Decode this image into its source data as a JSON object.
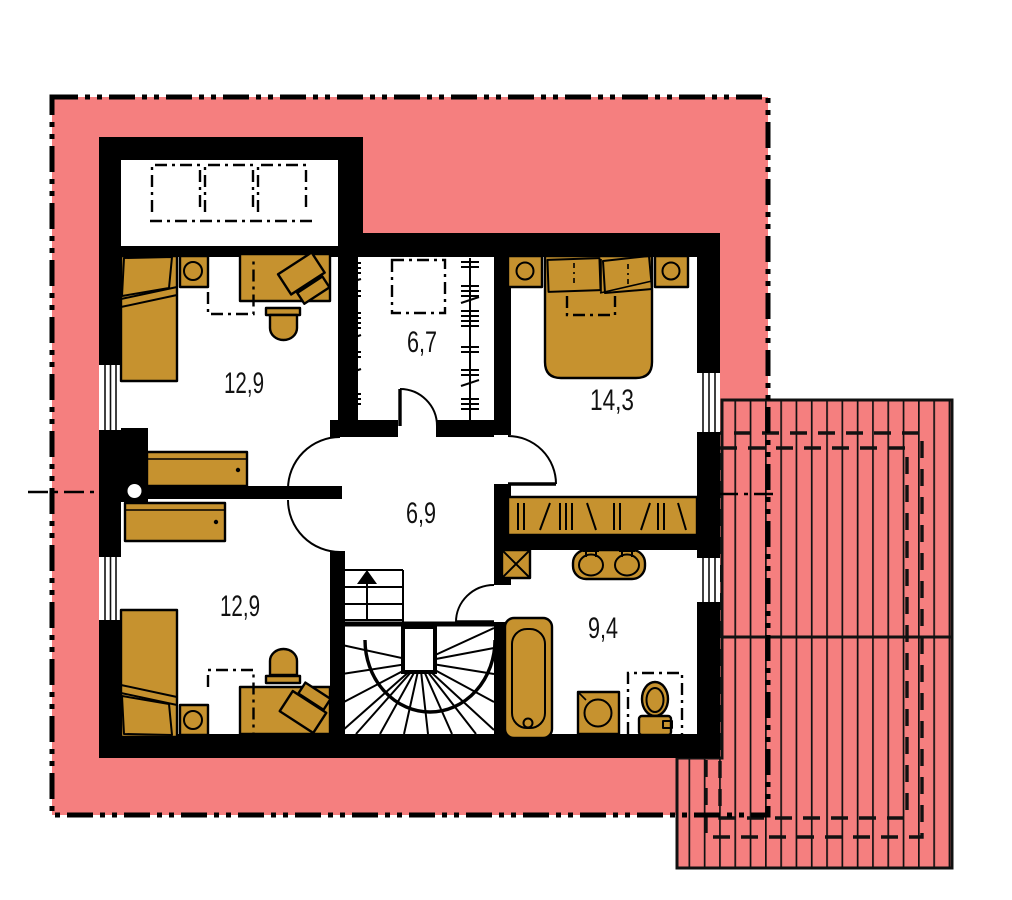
{
  "floor_plan": {
    "room_labels": [
      {
        "id": "bedroom-upper-left",
        "area": "12,9"
      },
      {
        "id": "walk-in-closet",
        "area": "6,7"
      },
      {
        "id": "bedroom-right",
        "area": "14,3"
      },
      {
        "id": "hallway",
        "area": "6,9"
      },
      {
        "id": "bedroom-lower-left",
        "area": "12,9"
      },
      {
        "id": "bathroom",
        "area": "9,4"
      }
    ],
    "colors": {
      "roof": "#F57F7F",
      "furniture": "#C6922F",
      "wall": "#000000",
      "background": "#FFFFFF"
    }
  }
}
